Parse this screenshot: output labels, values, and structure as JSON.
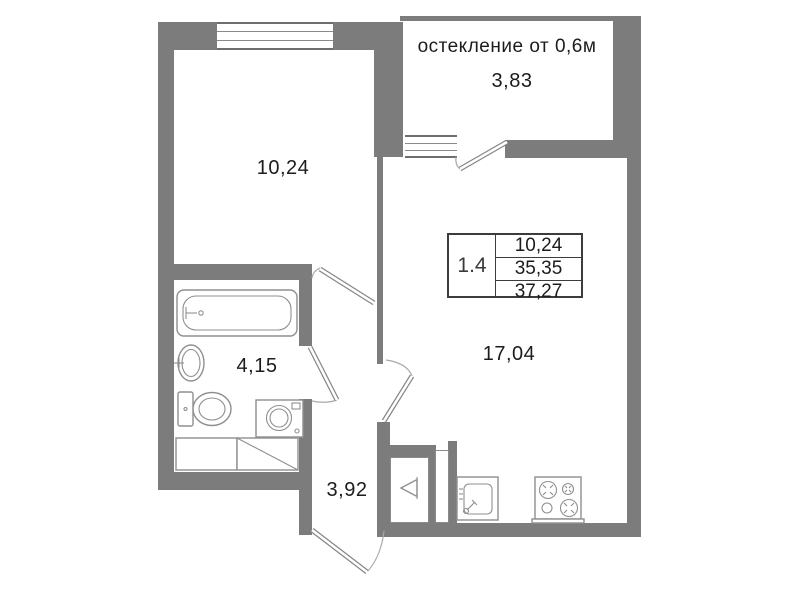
{
  "plan": {
    "balcony_note": "остекление от 0,6м",
    "rooms": [
      {
        "id": "bedroom",
        "area": "10,24"
      },
      {
        "id": "balcony",
        "area": "3,83"
      },
      {
        "id": "living-kitchen",
        "area": "17,04"
      },
      {
        "id": "bathroom",
        "area": "4,15"
      },
      {
        "id": "hallway",
        "area": "3,92"
      }
    ],
    "info_box": {
      "unit": "1.4",
      "rows": [
        "10,24",
        "35,35",
        "37,27"
      ]
    },
    "fixtures": [
      "bathtub",
      "washbasin",
      "toilet",
      "washing-machine",
      "wardrobe",
      "vent-shaft",
      "kitchen-sink",
      "stove"
    ],
    "colors": {
      "wall": "#7c7c7c",
      "fixture_line": "#8f8f8f",
      "table_border": "#3c3c3c",
      "text": "#1c1c1c"
    }
  }
}
